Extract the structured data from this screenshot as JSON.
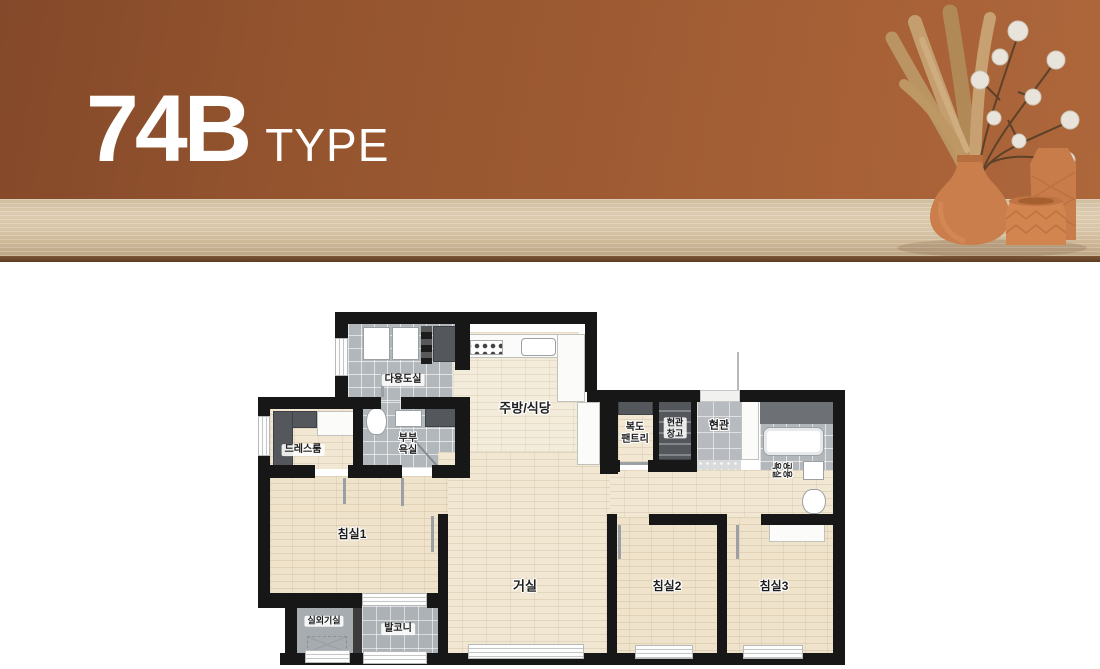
{
  "hero": {
    "title": "74B",
    "subtitle": "TYPE",
    "colors": {
      "wall_brown": "#9a5a30",
      "table_wood": "#d8c6a9",
      "title_white": "#ffffff",
      "terracotta_vase": "#ca7e4b",
      "cotton_white": "#e8e4db",
      "pampas_tan": "#c09a68"
    }
  },
  "floor_plan": {
    "labels": {
      "utility": "다용도실",
      "kitchen": "주방/식당",
      "dressroom": "드레스룸",
      "master_bath": "부부\n욕실",
      "pantry": "복도\n팬트리",
      "entry_storage": "현관\n창고",
      "entrance": "현관",
      "common_bath": "공용\n욕실",
      "bedroom1": "침실1",
      "living": "거실",
      "bedroom2": "침실2",
      "bedroom3": "침실3",
      "ac_room": "실외기실",
      "balcony": "발코니"
    },
    "colors": {
      "wall": "#171717",
      "wood_floor": "#f0e5cf",
      "tile_gray": "#b2b7bb",
      "cabinet_dark": "#54585c"
    }
  }
}
